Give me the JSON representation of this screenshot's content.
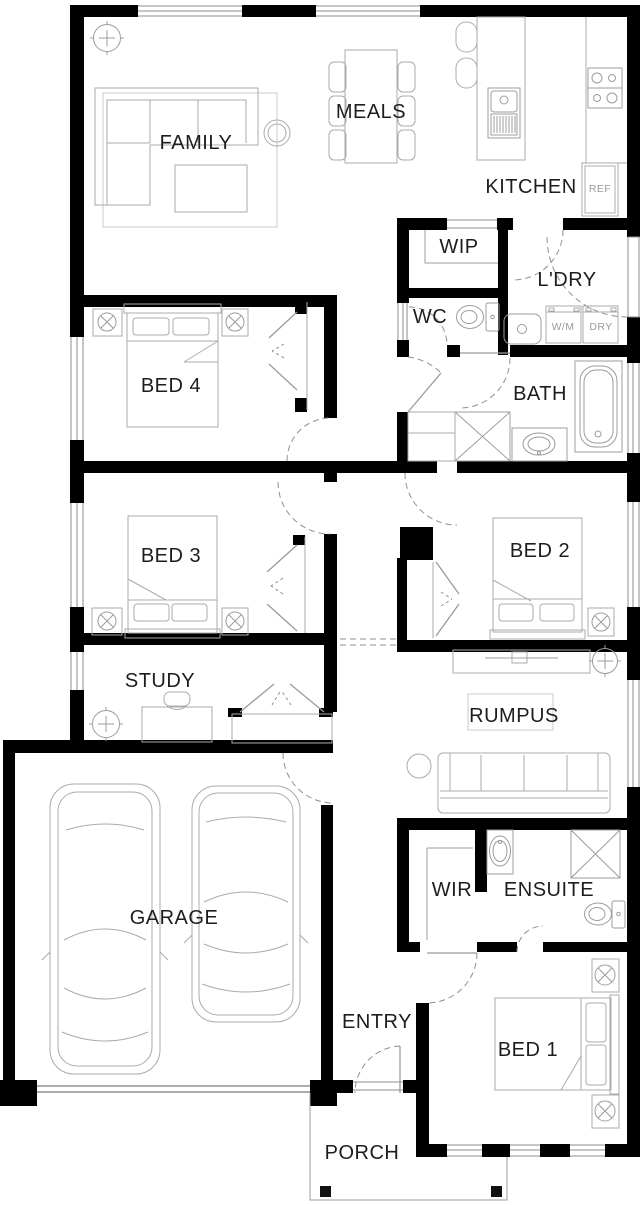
{
  "colors": {
    "background": "#ffffff",
    "wall": "#000000",
    "furniture_line": "#ababab",
    "fixture_line": "#9c9c9c",
    "door_arc": "#8f8f8f",
    "label_text": "#1d1d1d",
    "appliance_text": "#9a9a9a"
  },
  "rooms": {
    "family": "FAMILY",
    "meals": "MEALS",
    "kitchen": "KITCHEN",
    "wip": "WIP",
    "laundry": "L'DRY",
    "wc": "WC",
    "bath": "BATH",
    "bed4": "BED 4",
    "bed3": "BED 3",
    "bed2": "BED 2",
    "study": "STUDY",
    "rumpus": "RUMPUS",
    "garage": "GARAGE",
    "wir": "WIR",
    "ensuite": "ENSUITE",
    "entry": "ENTRY",
    "bed1": "BED 1",
    "porch": "PORCH"
  },
  "appliances": {
    "fridge": "REF",
    "washing_machine": "W/M",
    "dryer": "DRY"
  },
  "fixtures": [
    "ceiling-fan",
    "corner-sofa",
    "coffee-table",
    "rug",
    "dining-table",
    "dining-chair",
    "kitchen-island",
    "island-sink",
    "bar-stool",
    "cooktop",
    "fridge",
    "pantry-shelves",
    "toilet",
    "laundry-tub",
    "washing-machine",
    "dryer",
    "shower",
    "vanity-basin",
    "bathtub",
    "double-bed",
    "bedside-table",
    "bedside-lamp",
    "built-in-robe",
    "linen-cupboard",
    "desk",
    "desk-chair",
    "tv-unit",
    "sofa",
    "side-table",
    "car",
    "porch-post"
  ]
}
